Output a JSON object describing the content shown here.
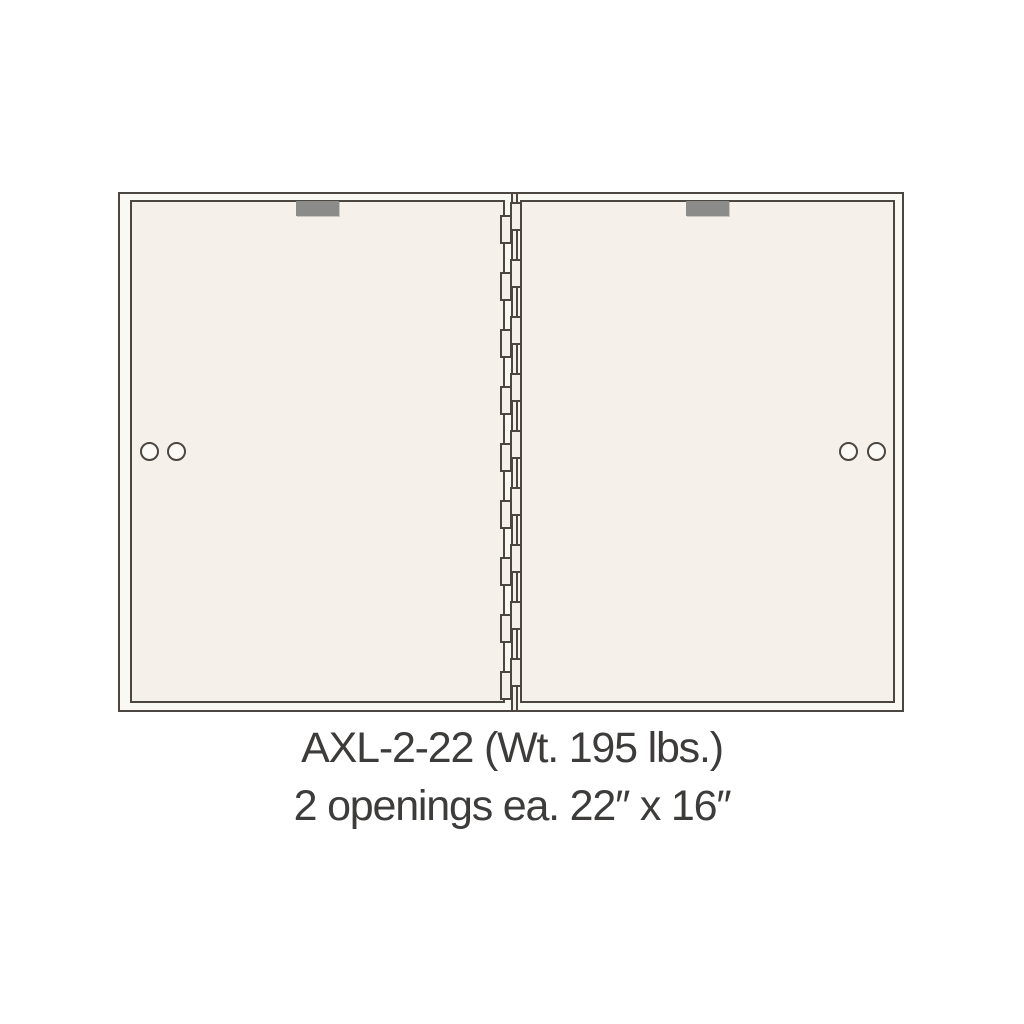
{
  "caption": {
    "model": "AXL-2-22 (Wt. 195 lbs.)",
    "openings": "2 openings ea. 22″ x 16″"
  },
  "diagram": {
    "type": "product-line-drawing",
    "subject": "front view of a 2-door safe deposit box unit with center hinge",
    "doors": [
      {
        "position": "left",
        "label_plate": "blank-gray",
        "lock_holes": 2,
        "locks_side": "left"
      },
      {
        "position": "right",
        "label_plate": "blank-gray",
        "lock_holes": 2,
        "locks_side": "right"
      }
    ],
    "hinge": {
      "location": "center-vertical",
      "knuckle_pairs": 9,
      "pair_start_y": 8,
      "pair_step_y": 57,
      "left_knuckle_offset_y": 13
    },
    "colors": {
      "page_background": "#ffffff",
      "line": "#4b463f",
      "door_fill": "#f5f1ea",
      "frame_fill": "#faf8f3",
      "label_plate": "#8b8b89",
      "caption_text": "#3d3c3a"
    }
  }
}
